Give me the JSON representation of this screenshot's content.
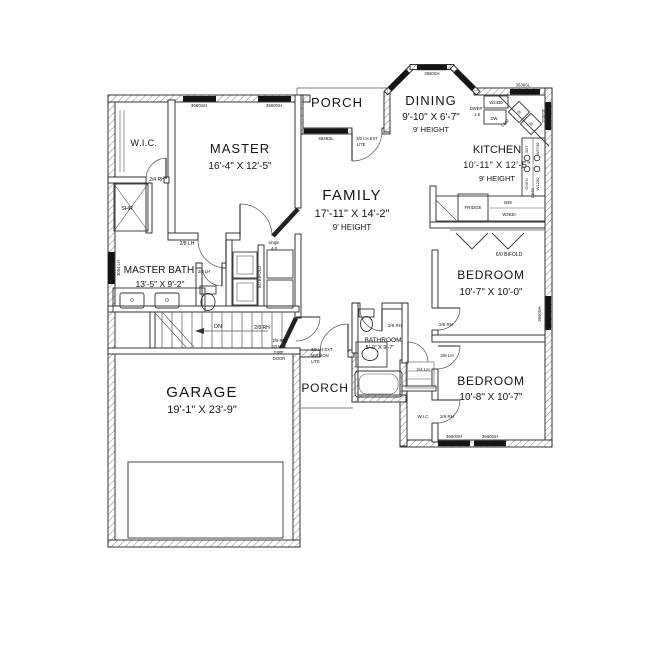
{
  "rooms": {
    "wic_master": {
      "name": "W.I.C."
    },
    "master": {
      "name": "MASTER",
      "dims": "16'-4\" X 12'-5\""
    },
    "porch_top": {
      "name": "PORCH"
    },
    "dining": {
      "name": "DINING",
      "dims": "9'-10\" X 6'-7\"",
      "height": "9' HEIGHT"
    },
    "kitchen": {
      "name": "KITCHEN",
      "dims": "10'-11\" X 12'-5\"",
      "height": "9' HEIGHT"
    },
    "family": {
      "name": "FAMILY",
      "dims": "17'-11\" X 14'-2\"",
      "height": "9' HEIGHT"
    },
    "master_bath": {
      "name": "MASTER BATH",
      "dims": "13'-5\" X 9'-2\""
    },
    "bathroom": {
      "name": "BATHROOM",
      "dims": "5'-0\" X 9'-7\""
    },
    "bedroom1": {
      "name": "BEDROOM",
      "dims": "10'-7\" X 10'-0\""
    },
    "bedroom2": {
      "name": "BEDROOM",
      "dims": "10'-8\" X 10'-7\""
    },
    "garage": {
      "name": "GARAGE",
      "dims": "19'-1\" X 23'-9\""
    },
    "porch_bottom": {
      "name": "PORCH"
    },
    "wic_bedroom2": {
      "name": "W.I.C"
    },
    "shower": {
      "name": "SHR"
    }
  },
  "doors": {
    "wic_master": "2/4 RH",
    "master_bath_entry": "2/8 LH",
    "master_entry_line1": "single",
    "master_entry_line2": "4-0",
    "toilet": "2/0 LH",
    "mb_closet": "5/0 BIFOLD",
    "stair": "2/8 RH",
    "fire_line1": "2/6 RH",
    "fire_line2": "20 MIN",
    "fire_line3": "FIRE",
    "fire_line4": "DOOR",
    "front_line1": "3/0 LH EXT",
    "front_line2": "LITE",
    "rear_line1": "3/0 LH EXT",
    "rear_line2": "MISSION",
    "rear_line3": "LITE",
    "bathroom": "2/8 RH",
    "bedroom1": "2/8 RH",
    "bedroom2": "2/8 LH",
    "linen": "2/4 LH",
    "wic_bedroom2": "2/6 RH",
    "hall_closet": "6/0 BIFOLD",
    "stairs_dn": "DN"
  },
  "windows": {
    "master_1": "3660SH",
    "master_2": "3660SH",
    "bay_left": "3660SH",
    "bay_center": "3660SH",
    "bay_right": "3660SH",
    "family_front": "4848SL",
    "kitchen_sink": "3636SL",
    "kitchen_side": "3030SL",
    "bedroom1_side": "3660SH",
    "bedroom2_1": "3660SH",
    "bedroom2_2": "3660SH",
    "master_bath_side": "3054 LH"
  },
  "kitchen_items": {
    "w2430": "W2430",
    "dw": "DW",
    "dwep": "DWEP",
    "dwep_size": "1.5",
    "fridge": "FRIDGE",
    "b39": "B39",
    "w3930": "W3930",
    "b27": "B27",
    "w2730": "W2730",
    "oven": "OVEN",
    "cb62": "CB62",
    "w1230": "W1230",
    "c362": "C362"
  }
}
